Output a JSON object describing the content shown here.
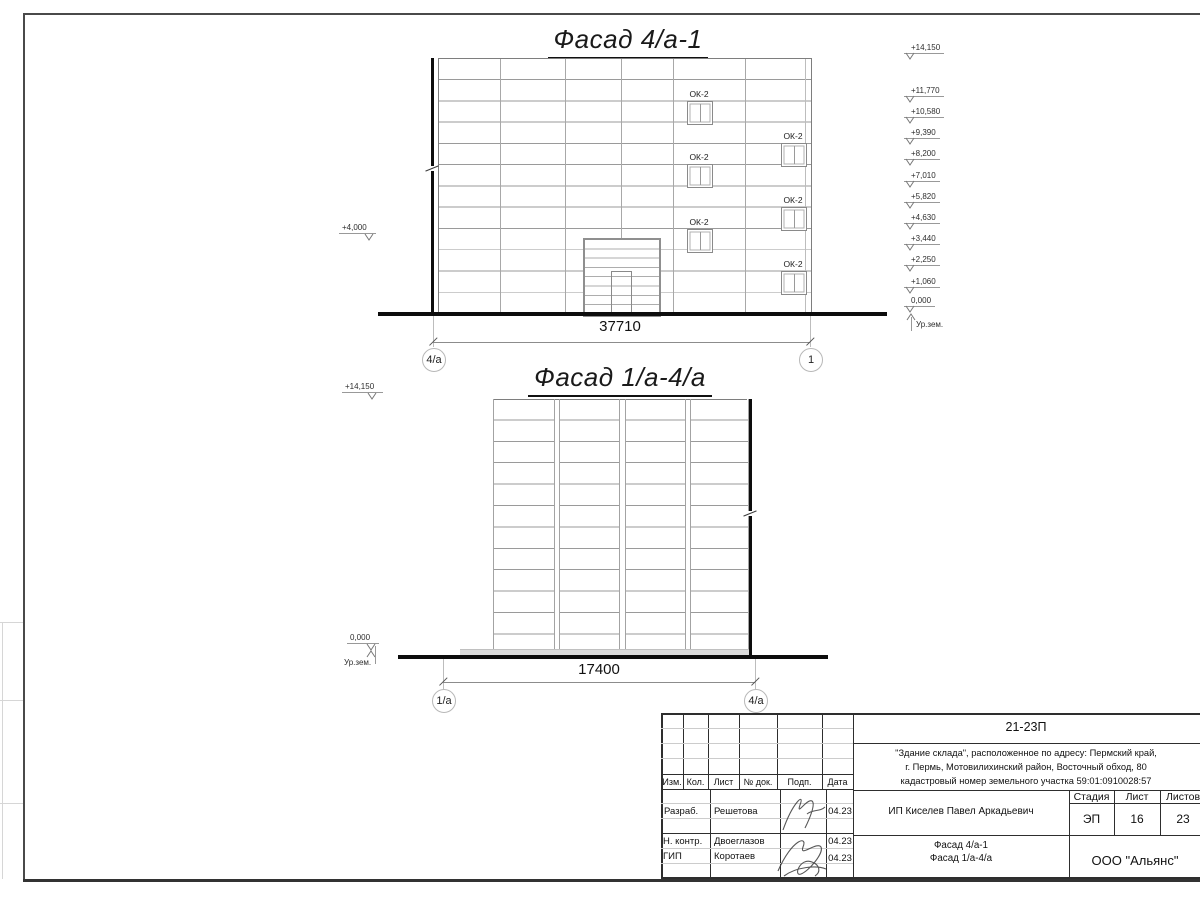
{
  "facade1": {
    "title": "Фасад 4/а-1",
    "dimension": "37710",
    "axis_left": "4/а",
    "axis_right": "1",
    "window_label": "ОК-2",
    "elevation_left": "+4,000"
  },
  "facade2": {
    "title": "Фасад 1/а-4/а",
    "dimension": "17400",
    "axis_left": "1/а",
    "axis_right": "4/а",
    "elevation_top": "+14,150",
    "elevation_zero": "0,000",
    "ground_label": "Ур.зем."
  },
  "elevations": {
    "marks": [
      "+14,150",
      "+11,770",
      "+10,580",
      "+9,390",
      "+8,200",
      "+7,010",
      "+5,820",
      "+4,630",
      "+3,440",
      "+2,250",
      "+1,060",
      "0,000"
    ],
    "ground_label": "Ур.зем."
  },
  "titleblock": {
    "code": "21-23П",
    "project_lines": [
      "\"Здание склада\", расположенное по адресу: Пермский край,",
      "г. Пермь, Мотовилихинский район, Восточный обход, 80",
      "кадастровый номер земельного участка 59:01:0910028:57"
    ],
    "cols": [
      "Изм.",
      "Кол.",
      "Лист",
      "№ док.",
      "Подп.",
      "Дата"
    ],
    "rows": [
      {
        "role": "Разраб.",
        "name": "Решетова",
        "date": "04.23"
      },
      {
        "role": "Н. контр.",
        "name": "Двоеглазов",
        "date": "04.23"
      },
      {
        "role": "ГИП",
        "name": "Коротаев",
        "date": "04.23"
      }
    ],
    "client": "ИП Киселев Павел Аркадьевич",
    "stage_label": "Стадия",
    "sheet_label": "Лист",
    "sheets_label": "Листов",
    "stage": "ЭП",
    "sheet": "16",
    "sheets": "23",
    "sheet_title_lines": [
      "Фасад 4/а-1",
      "Фасад 1/а-4/а"
    ],
    "company": "ООО \"Альянс\""
  }
}
